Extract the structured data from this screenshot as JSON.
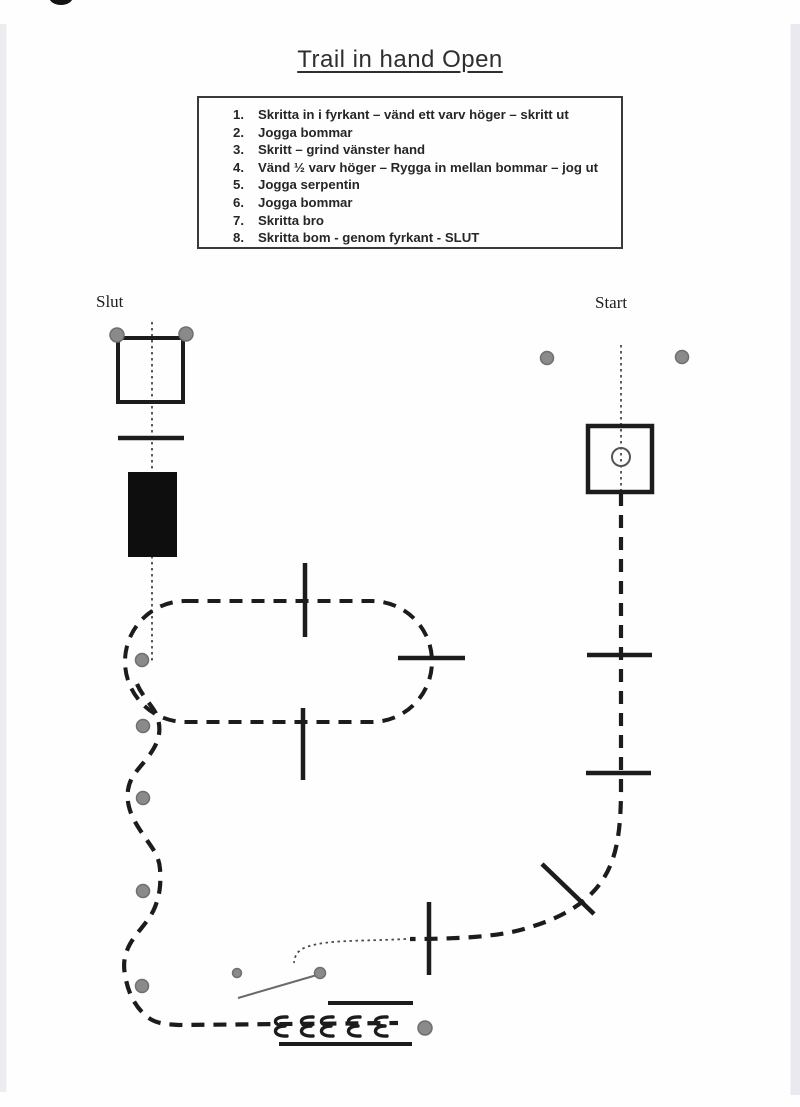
{
  "page": {
    "title": "Trail in hand Open"
  },
  "instructions": {
    "items": [
      {
        "number": "1.",
        "text": "Skritta in i fyrkant – vänd ett varv höger – skritt ut"
      },
      {
        "number": "2.",
        "text": "Jogga bommar"
      },
      {
        "number": "3.",
        "text": "Skritt – grind vänster hand"
      },
      {
        "number": "4.",
        "text": "Vänd ½ varv höger – Rygga in mellan bommar – jog ut"
      },
      {
        "number": "5.",
        "text": "Jogga serpentin"
      },
      {
        "number": "6.",
        "text": "Jogga bommar"
      },
      {
        "number": "7.",
        "text": "Skritta bro"
      },
      {
        "number": "8.",
        "text": "Skritta bom - genom fyrkant - SLUT"
      }
    ]
  },
  "course": {
    "start_label": "Start",
    "end_label": "Slut",
    "colors": {
      "ink": "#1c1c1c",
      "cone_fill": "#8a8a8a",
      "cone_rim": "#6f6f6f",
      "walk_path": "#4a4a4a",
      "gate_line": "#6a6a6a"
    }
  }
}
